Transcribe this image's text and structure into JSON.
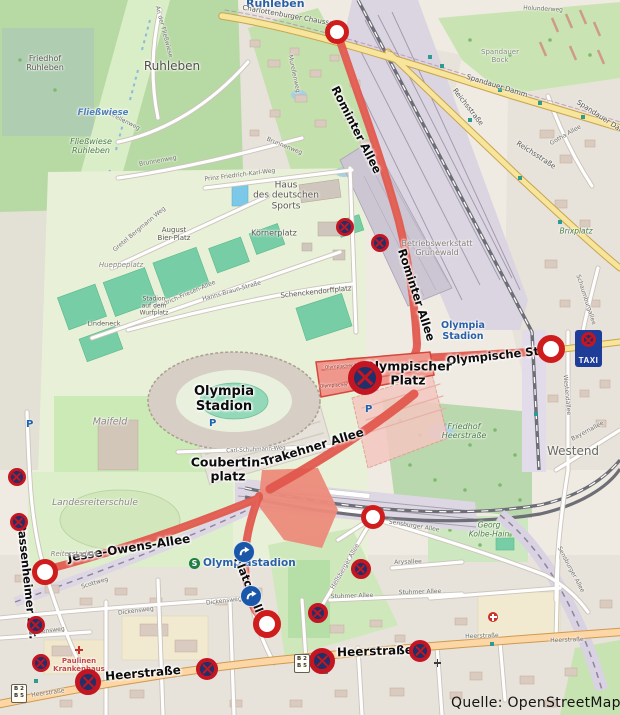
{
  "attribution": "Quelle: OpenStreetMaps",
  "colors": {
    "highlight_route": "#e2564b",
    "closed_area_fill": "#ef978c",
    "marker_ring_red": "#c41522",
    "marker_navy": "#203069",
    "roundabout_blue": "#1b57a8",
    "taxi_sign_blue": "#1e3d99",
    "yellow_road": "#f7e59b",
    "primary_road_orange": "#fcd6a4"
  },
  "stations": {
    "ruhleben": "Ruhleben",
    "olympia_stadion": "Olympia\nStadion",
    "olympiastadion": "Olympiastadion",
    "s_logo": "S"
  },
  "annotations": {
    "rominter1": "Rominter Allee",
    "rominter2": "Rominter Allee",
    "olympische_str": "Olympische Str.",
    "olympischer_platz": "Olympischer\nPlatz",
    "olympia_stadion_big": "Olympia\nStadion",
    "coubertinplatz": "Coubertin-\nplatz",
    "trakehner": "Trakehner Allee",
    "jesse_owens": "Jesse-Owens-Allee",
    "passenheimer": "Passenheimer Str.",
    "flatowallee": "Flatowallee",
    "heerstrasse_w": "Heerstraße",
    "heerstrasse_e": "Heerstraße"
  },
  "streets": {
    "charlottenburger": "Charlottenburger Chaussee",
    "spandauer1": "Spandauer Damm",
    "spandauer2": "Spandauer Damm",
    "reichs1": "Reichsstraße",
    "reichs2": "Reichsstraße",
    "holunderweg": "Holunderweg",
    "gotha": "Gotha Allee",
    "murellenweg1": "Murellenweg",
    "murellenweg2": "Murellenweg",
    "brunnenweg1": "Brunnenweg",
    "brunnenweg2": "Brunnenweg",
    "an_der_fliesswiese": "An der Fließwiese",
    "prinz_weg": "Prinz Friedrich-Karl-Weg",
    "gretel": "Gretel Bergmann Weg",
    "friesen": "Friedrich-Friesen-Allee",
    "hanns_braun": "Hanns-Braun-Straße",
    "carl_schuhmann": "Carl-Schuhmann-Weg",
    "scottweg": "Scottweg",
    "sensburger1": "Sensburger Allee",
    "sensburger2": "Sensburger Allee",
    "arysallee": "Arysallee",
    "stuhmer1": "Stuhmer Allee",
    "stuhmer2": "Stuhmer Allee",
    "heilsberger": "Heilsberger Allee",
    "dickensweg1": "Dickensweg",
    "dickensweg2": "Dickensweg",
    "dickensweg3": "Dickensweg",
    "schaumburgallee": "Schaumburgallee",
    "westendallee": "Westendallee",
    "bayernallee": "Bayernallee",
    "heer_sm1": "Heerstraße",
    "heer_sm2": "Heerstraße",
    "heer_sm3": "Heerstraße"
  },
  "places": {
    "ruhleben": "Ruhleben",
    "friedhof_ruhleben": "Friedhof\nRuhleben",
    "fliesswiese": "Fließwiese",
    "fliesswiese_ruhleben": "Fließwiese\nRuhleben",
    "spandauer_bock": "Spandauer\nBock",
    "haus_sports": "Haus\ndes deutschen\nSports",
    "koernerplatz": "Körnerplatz",
    "august_bier": "August\nBier-Platz",
    "hueppeplatz": "Hueppeplatz",
    "wurfplatz": "Stadion\nauf dem\nWurfplatz",
    "schenckendorff": "Schenckendorffplatz",
    "lindeneck": "Lindeneck",
    "maifeld": "Maifeld",
    "landesreiterschule": "Landesreiterschule",
    "reiterstadion": "Reiterstadion",
    "betriebswerkstatt": "Betriebswerkstatt\nGrunewald",
    "brixplatz": "Brixplatz",
    "westend": "Westend",
    "friedhof_heer": "Friedhof\nHeerstraße",
    "georg_kolbe": "Georg\nKolbe-Hain",
    "paulinen": "Paulinen\nKrankenhaus",
    "platz_small1": "Olympischer Platz",
    "platz_small2": "Olympischer Platz"
  },
  "signs": {
    "taxi": "TAXI",
    "b_shield": "B 2\nB 5",
    "parking": "P"
  },
  "icons": {
    "closure_marker": "road-closed-ring",
    "no_stopping_marker": "no-stopping-cross",
    "roundabout_marker": "roundabout-arrow"
  }
}
